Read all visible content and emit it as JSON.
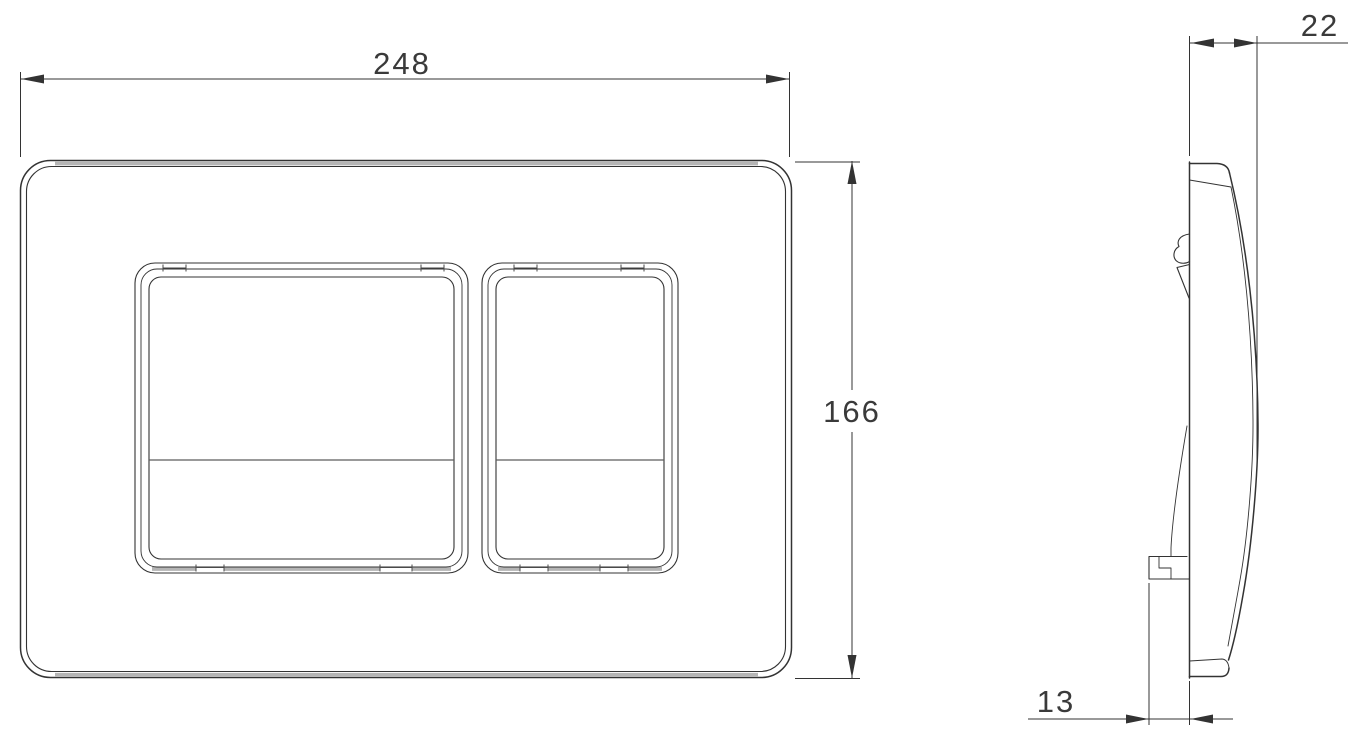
{
  "dimensions": {
    "front_width": "248",
    "front_height": "166",
    "side_depth": "22",
    "side_bracket_offset": "13"
  },
  "colors": {
    "line": "#333333",
    "shade": "#b5b5b5",
    "text": "#3a3a3a",
    "background": "#ffffff"
  }
}
